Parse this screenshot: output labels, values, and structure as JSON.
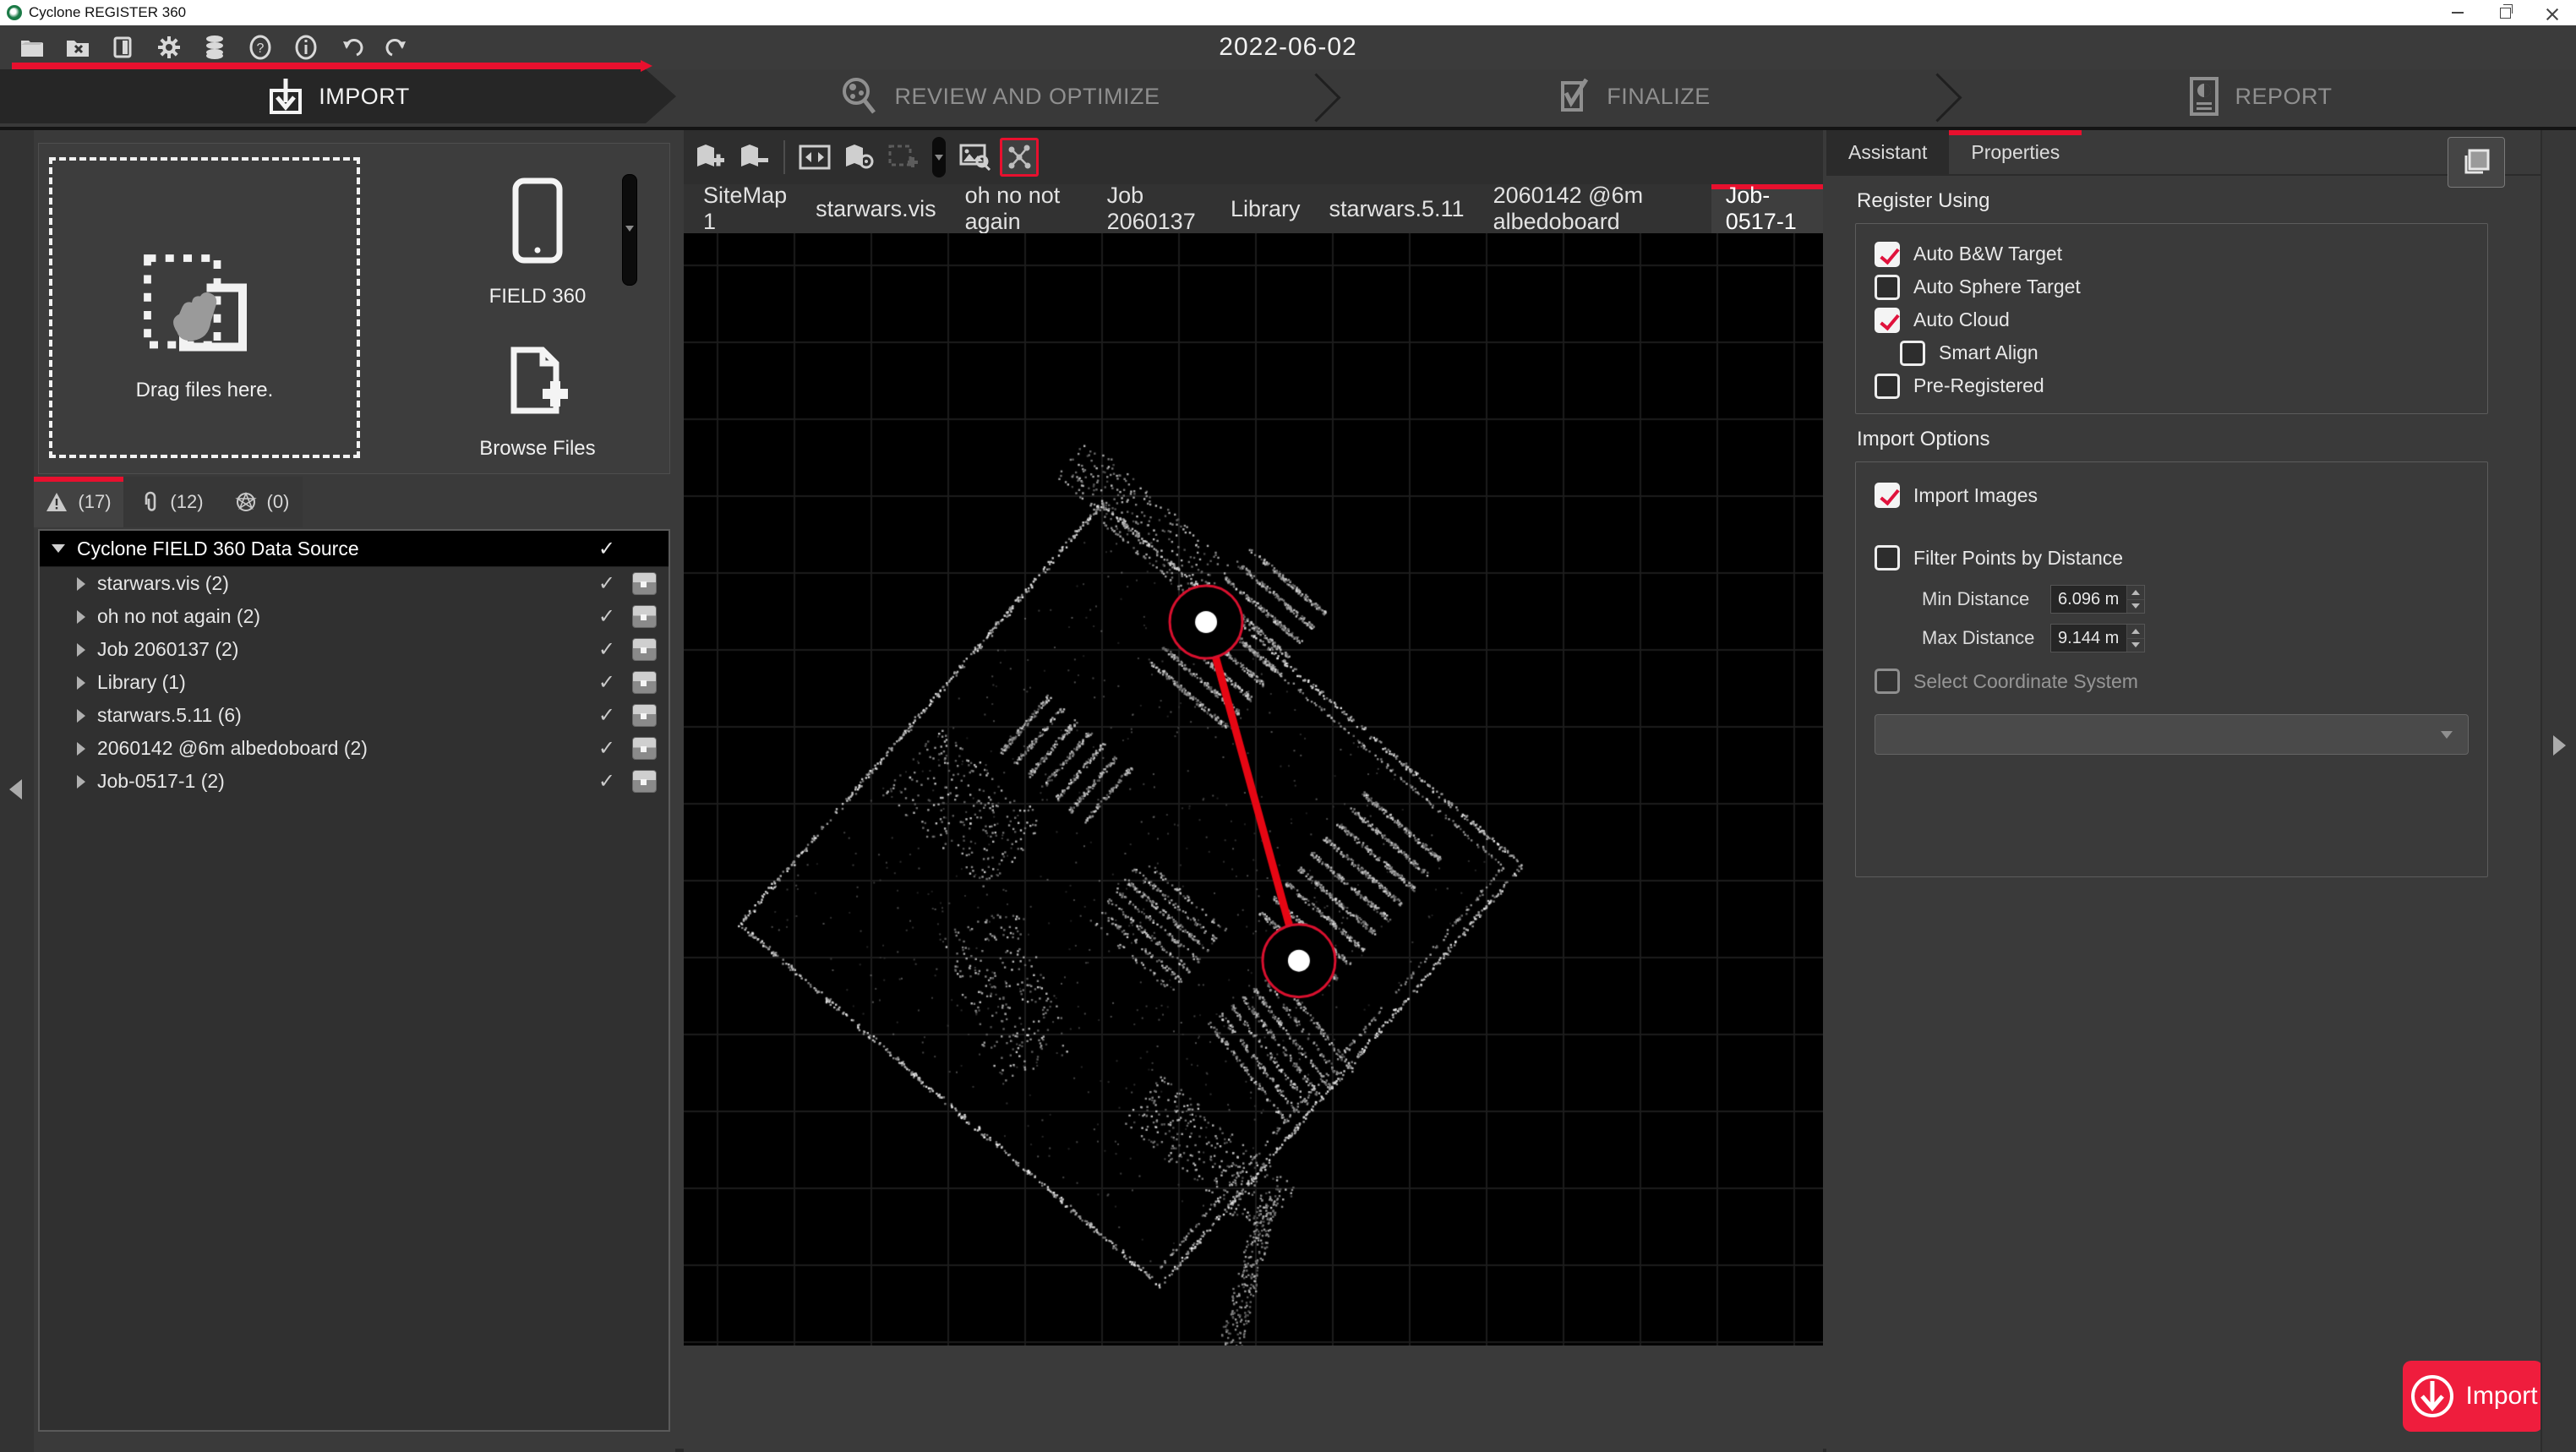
{
  "window": {
    "title": "Cyclone REGISTER 360",
    "date": "2022-06-02"
  },
  "workflow": {
    "steps": [
      {
        "label": "IMPORT",
        "active": true
      },
      {
        "label": "REVIEW AND OPTIMIZE",
        "active": false
      },
      {
        "label": "FINALIZE",
        "active": false
      },
      {
        "label": "REPORT",
        "active": false
      }
    ]
  },
  "left_panel": {
    "dropzone_label": "Drag files here.",
    "field360_label": "FIELD 360",
    "browse_label": "Browse Files",
    "tabs": [
      {
        "count": "(17)",
        "active": true
      },
      {
        "count": "(12)",
        "active": false
      },
      {
        "count": "(0)",
        "active": false
      }
    ],
    "tree": {
      "root": {
        "label": "Cyclone FIELD 360 Data Source",
        "checked": true
      },
      "items": [
        {
          "label": "starwars.vis (2)",
          "checked": true
        },
        {
          "label": "oh no not again (2)",
          "checked": true
        },
        {
          "label": "Job 2060137 (2)",
          "checked": true
        },
        {
          "label": "Library (1)",
          "checked": true
        },
        {
          "label": "starwars.5.11 (6)",
          "checked": true
        },
        {
          "label": "2060142 @6m albedoboard (2)",
          "checked": true
        },
        {
          "label": "Job-0517-1 (2)",
          "checked": true
        }
      ]
    }
  },
  "viewer": {
    "canvas": {
      "bg": "#000000",
      "grid": "#1c1c1c"
    },
    "tabs": [
      {
        "label": "SiteMap 1",
        "active": false
      },
      {
        "label": "starwars.vis",
        "active": false
      },
      {
        "label": "oh no not again",
        "active": false
      },
      {
        "label": "Job 2060137",
        "active": false
      },
      {
        "label": "Library",
        "active": false
      },
      {
        "label": "starwars.5.11",
        "active": false
      },
      {
        "label": "2060142 @6m albedoboard",
        "active": false
      },
      {
        "label": "Job-0517-1",
        "active": true
      }
    ],
    "link": {
      "x1": 0.4585,
      "y1": 0.3495,
      "x2": 0.54,
      "y2": 0.654,
      "line_color": "#e60613",
      "ring_color": "#d8102e",
      "node_fill": "#ffffff"
    }
  },
  "right_panel": {
    "tabs": [
      {
        "label": "Assistant",
        "active": false
      },
      {
        "label": "Properties",
        "active": true
      }
    ],
    "register_using": {
      "title": "Register Using",
      "options": [
        {
          "label": "Auto B&W Target",
          "checked": true
        },
        {
          "label": "Auto Sphere Target",
          "checked": false
        },
        {
          "label": "Auto Cloud",
          "checked": true
        },
        {
          "label": "Smart Align",
          "checked": false
        },
        {
          "label": "Pre-Registered",
          "checked": false
        }
      ]
    },
    "import_options": {
      "title": "Import Options",
      "import_images": {
        "label": "Import Images",
        "checked": true
      },
      "filter_points": {
        "label": "Filter Points by Distance",
        "checked": false
      },
      "min_distance": {
        "label": "Min Distance",
        "value": "6.096 m"
      },
      "max_distance": {
        "label": "Max Distance",
        "value": "9.144 m"
      },
      "coordinate_system": {
        "label": "Select Coordinate System",
        "checked": false,
        "disabled": true,
        "selected": ""
      }
    }
  },
  "import_button": {
    "label": "Import",
    "color": "#ef1d3d"
  },
  "accent_color": "#e8102e"
}
